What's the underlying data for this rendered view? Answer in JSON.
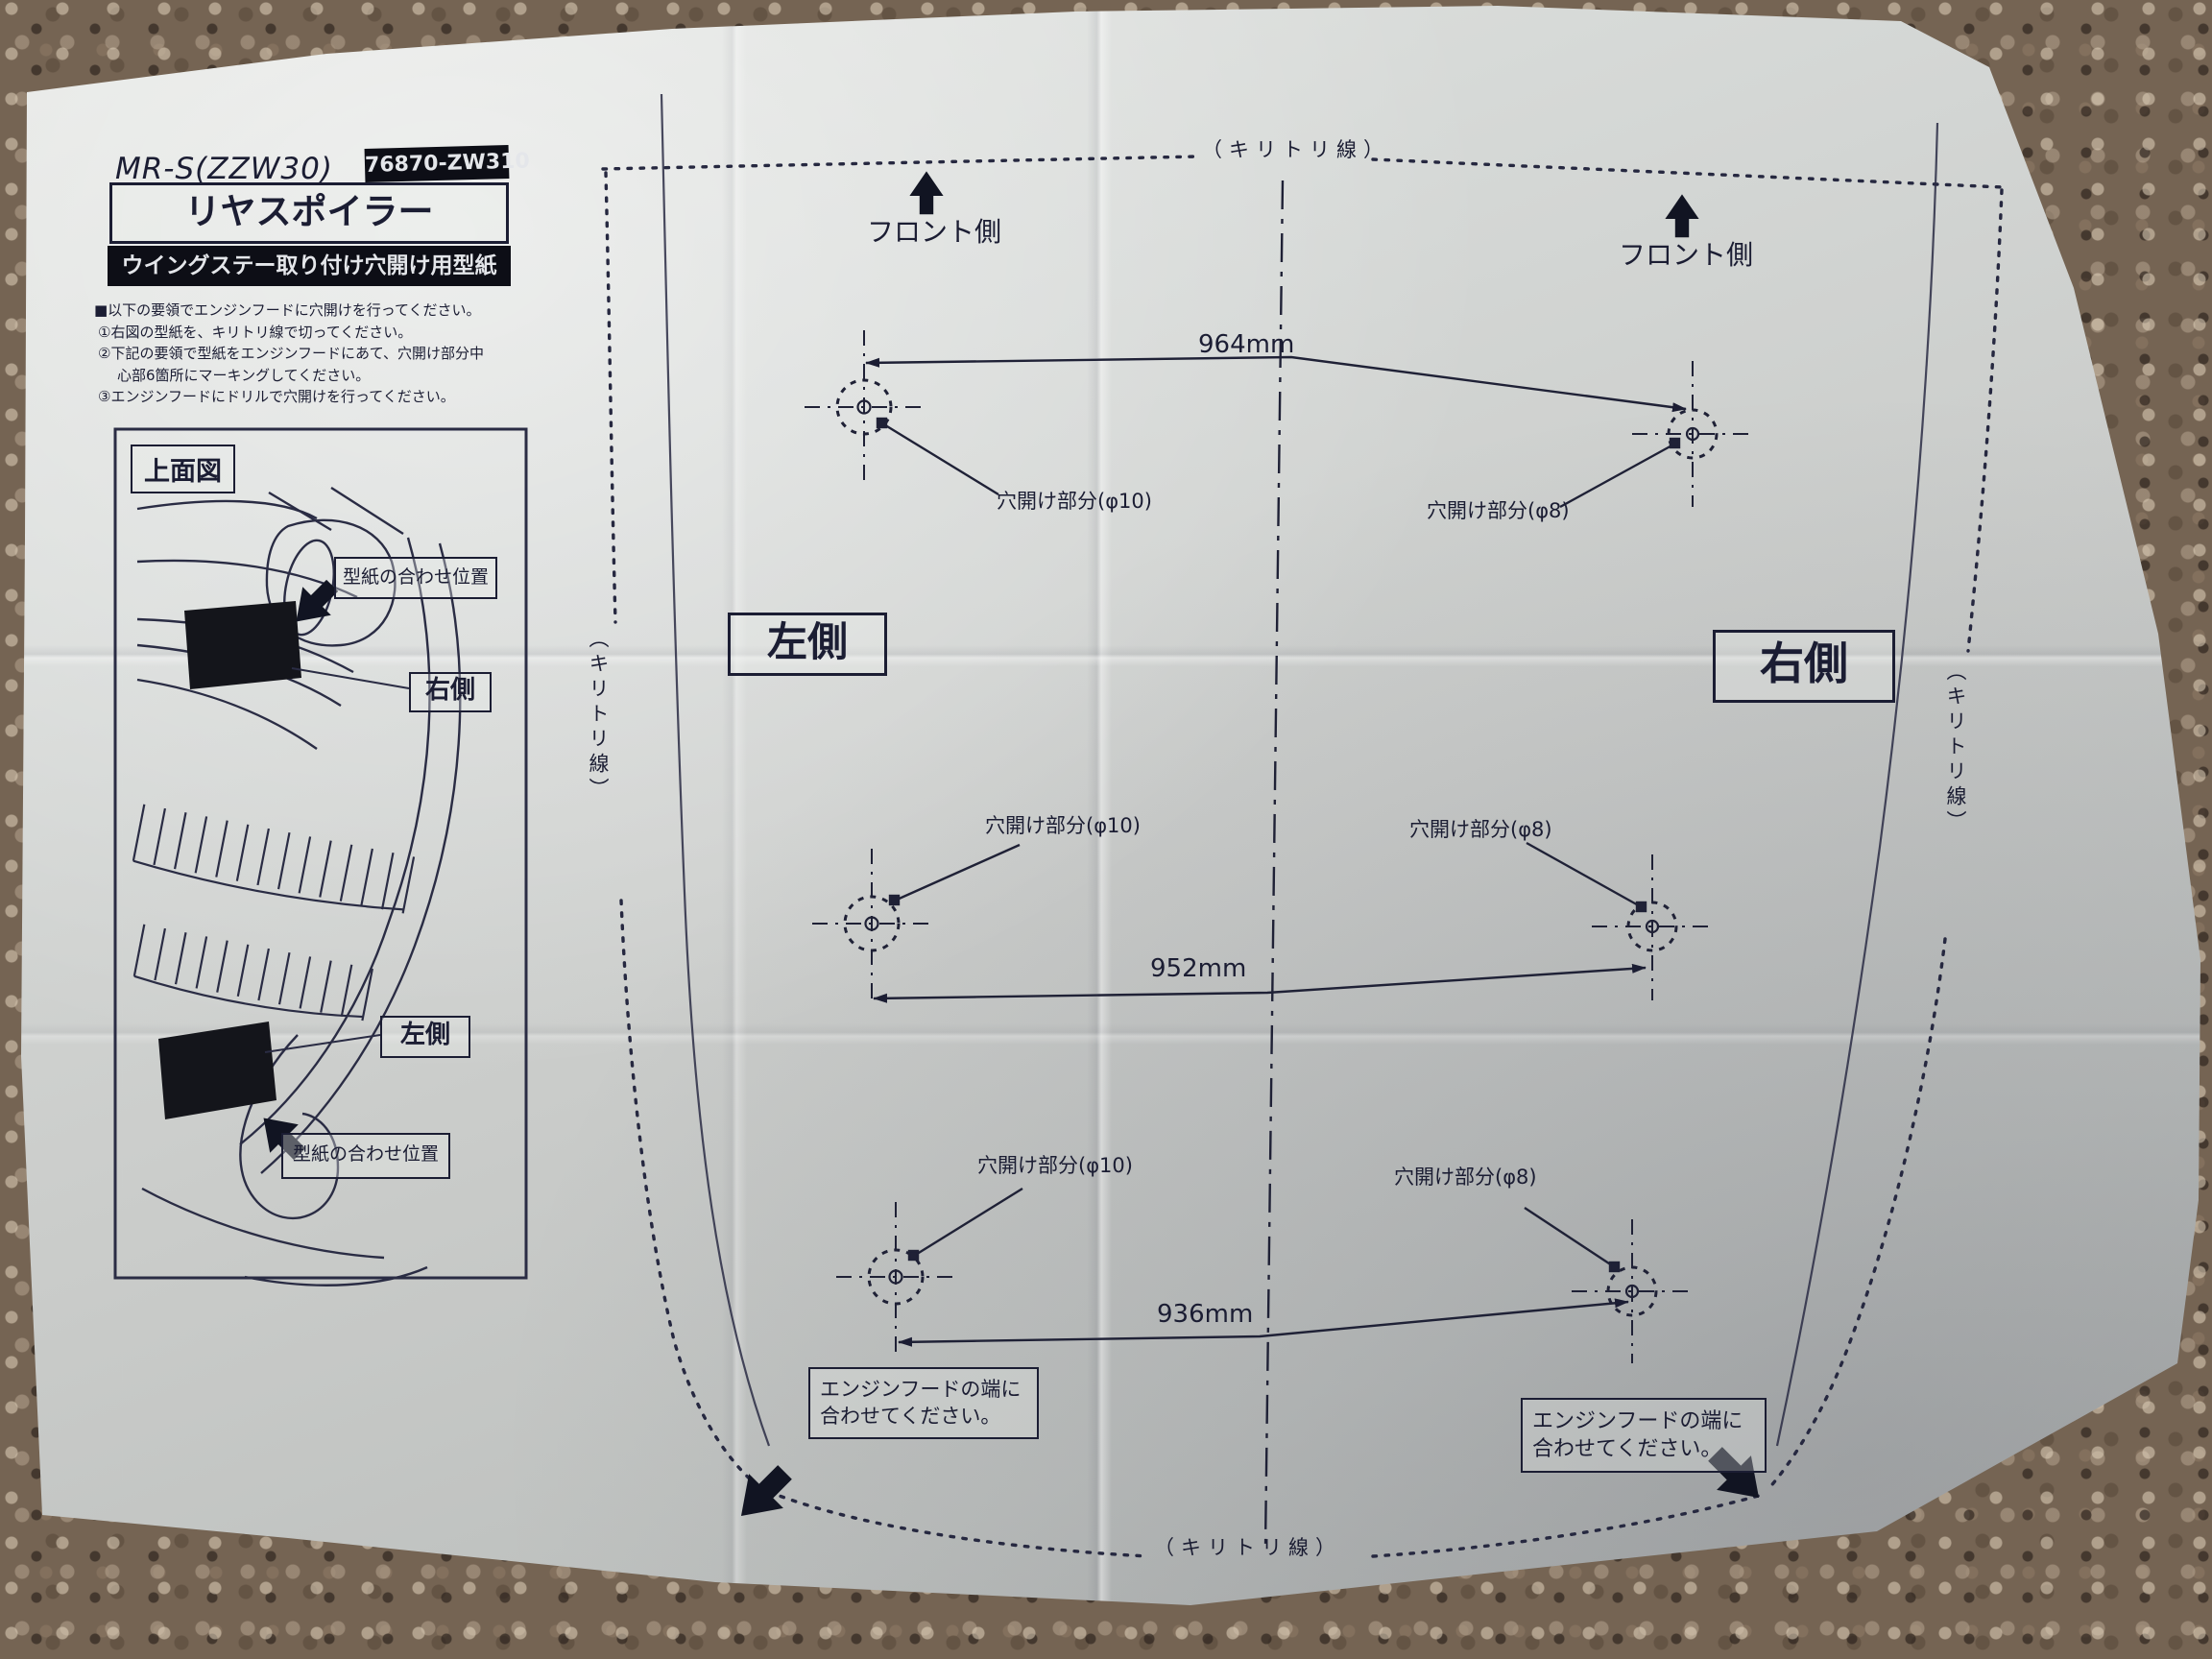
{
  "sheet": {
    "model": "MR-S(ZZW30)",
    "part_number": "76870-ZW310",
    "title": "リヤスポイラー",
    "subtitle": "ウイングステー取り付け穴開け用型紙",
    "instructions": {
      "intro": "■以下の要領でエンジンフードに穴開けを行ってください。",
      "step1": "①右図の型紙を、キリトリ線で切ってください。",
      "step2": "②下記の要領で型紙をエンジンフードにあて、穴開け部分中心部6箇所にマーキングしてください。",
      "step3": "③エンジンフードにドリルで穴開けを行ってください。"
    },
    "top_view": {
      "title": "上面図",
      "align_position": "型紙の合わせ位置",
      "right_side": "右側",
      "left_side": "左側"
    },
    "template": {
      "cut_line": "（キリトリ線）",
      "front_side": "フロント側",
      "left_side": "左側",
      "right_side": "右側",
      "hole_phi10": "穴開け部分(φ10)",
      "hole_phi8": "穴開け部分(φ8)",
      "dim_top": "964mm",
      "dim_middle": "952mm",
      "dim_bottom": "936mm",
      "hood_edge_note": "エンジンフードの端に合わせてください。"
    }
  }
}
